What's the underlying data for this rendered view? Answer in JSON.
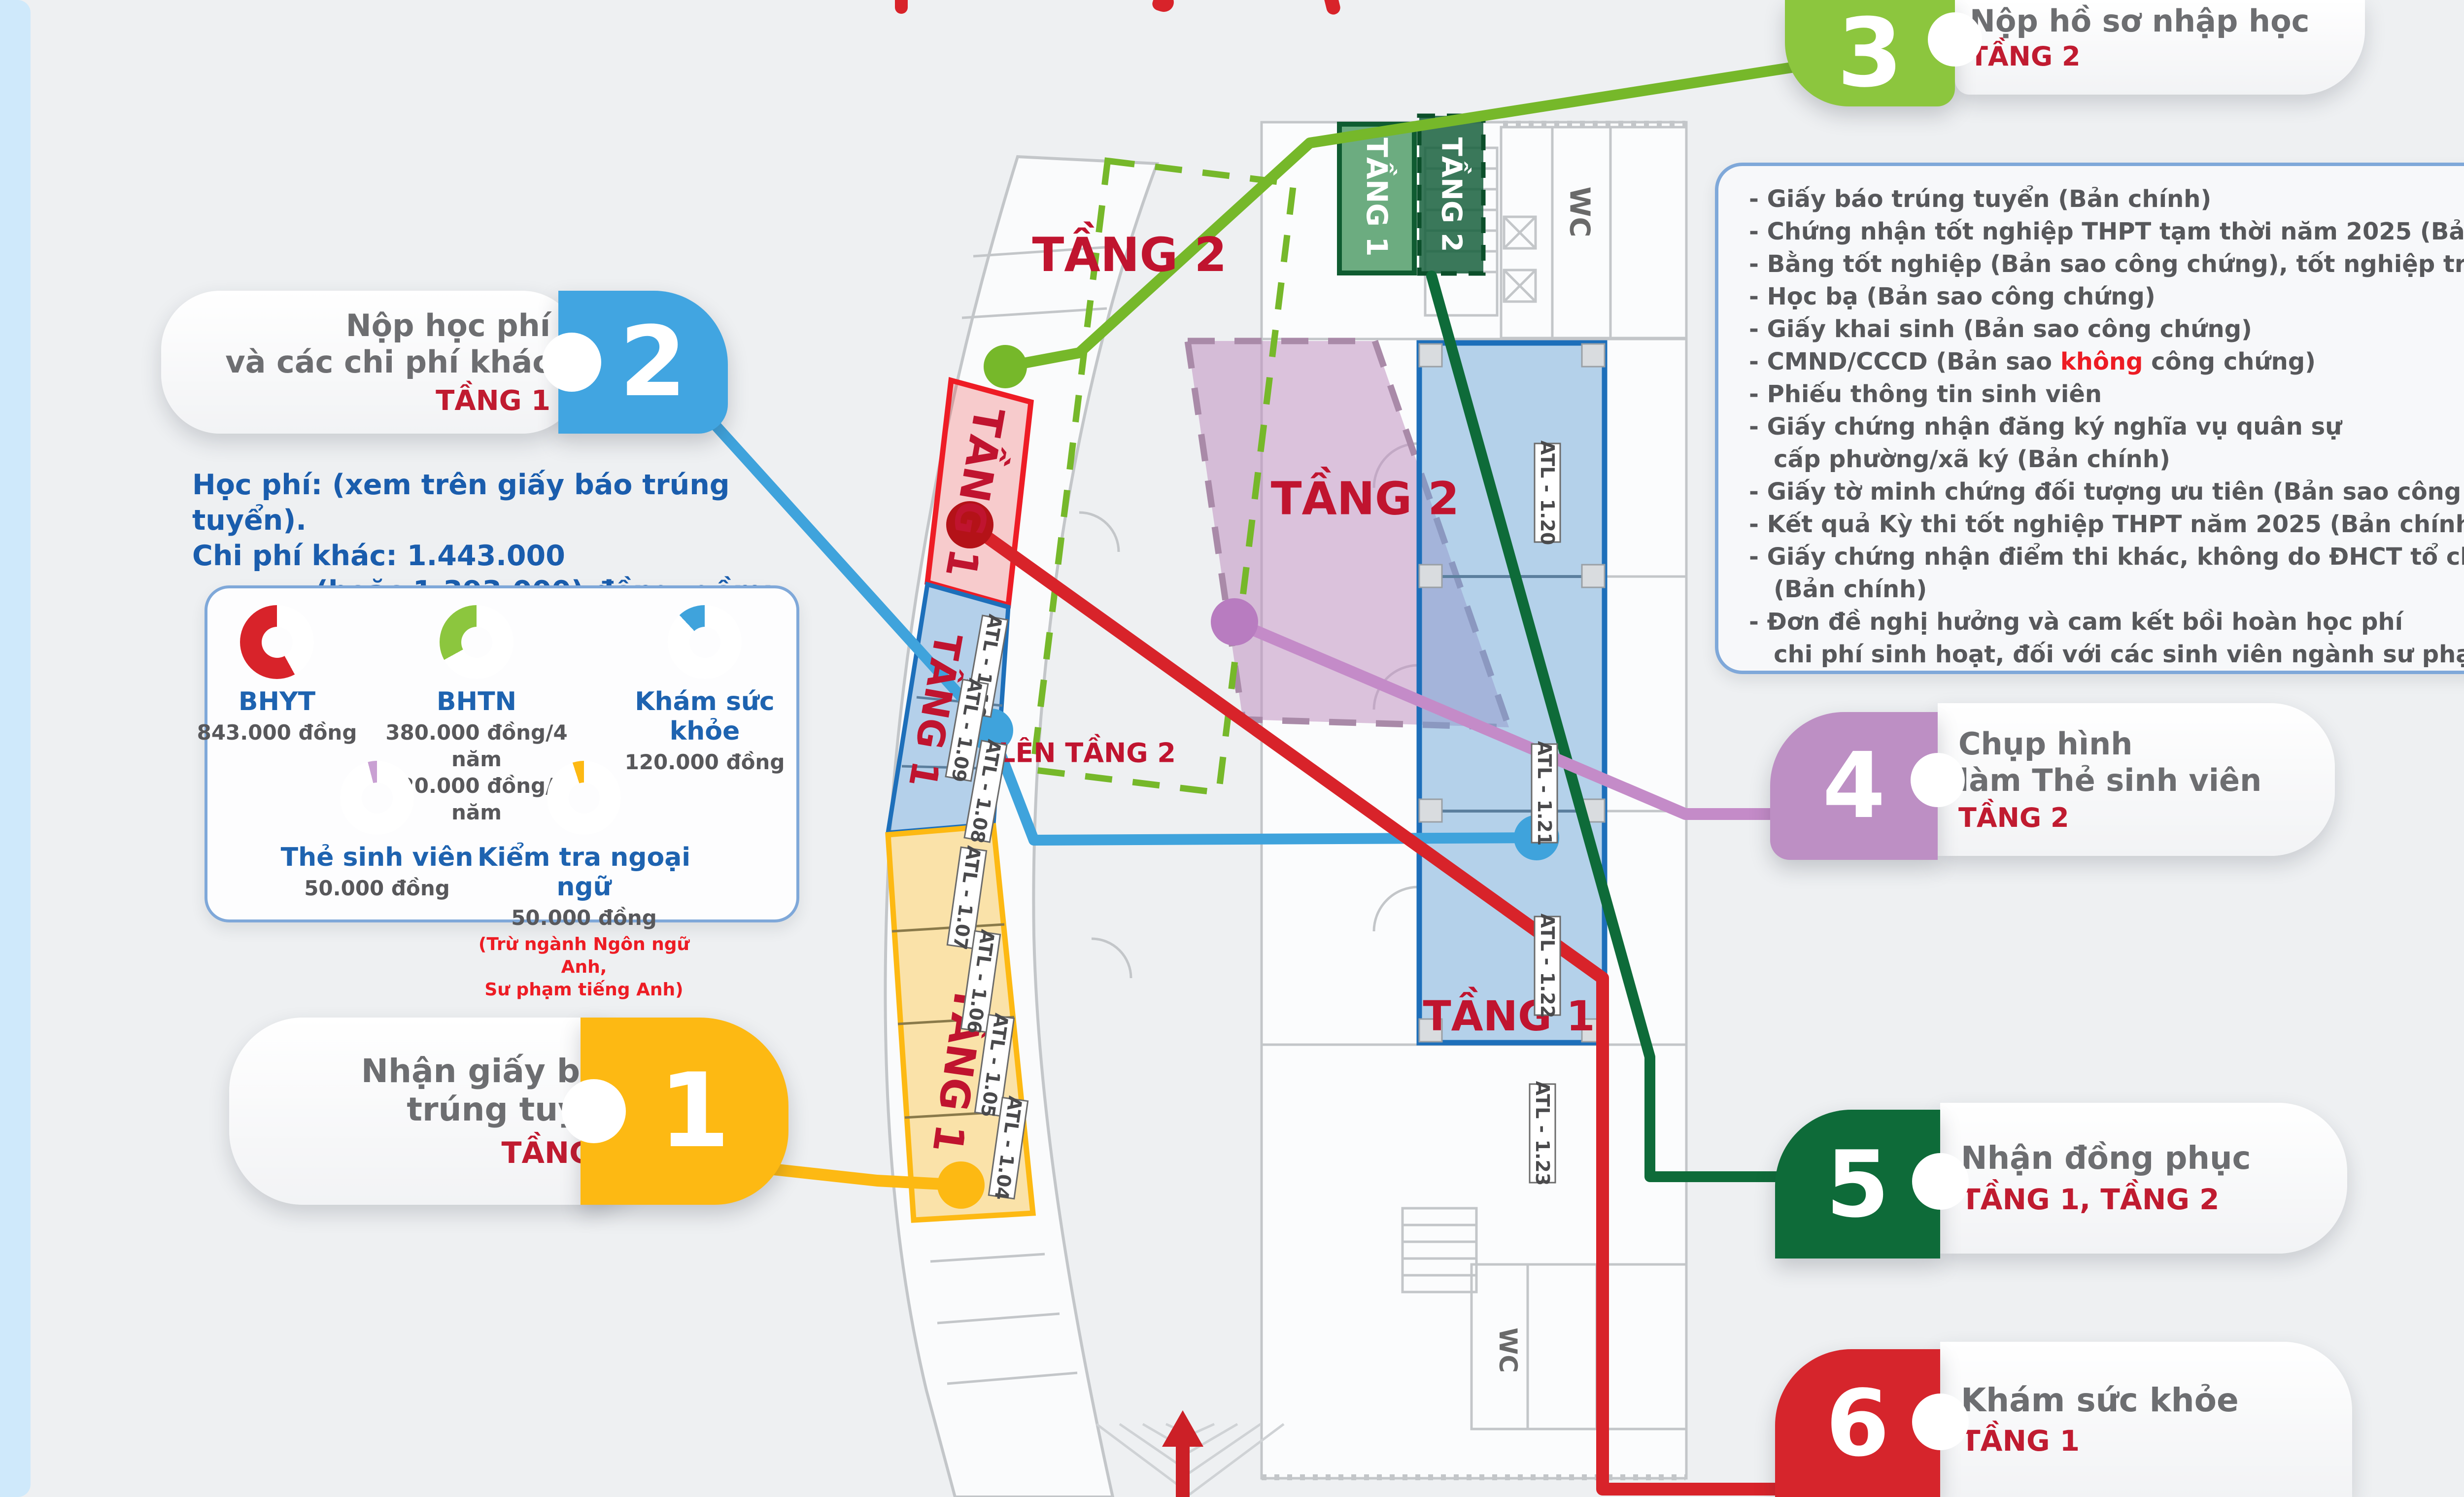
{
  "badges": [
    {
      "num": "1",
      "line1": "Nhận giấy báo",
      "line2": "trúng tuyển",
      "floor": "TẦNG 1",
      "color": "#fdb913"
    },
    {
      "num": "2",
      "line1": "Nộp học phí",
      "line2": "và các chi phí khác",
      "floor": "TẦNG 1",
      "color": "#41a5e1"
    },
    {
      "num": "3",
      "line1": "Nộp hồ sơ nhập học",
      "line2": "",
      "floor": "TẦNG 2",
      "color": "#8cc63e"
    },
    {
      "num": "4",
      "line1": "Chụp hình",
      "line2": "làm Thẻ sinh viên",
      "floor": "TẦNG 2",
      "color": "#bd8fc4"
    },
    {
      "num": "5",
      "line1": "Nhận đồng phục",
      "line2": "",
      "floor": "TẦNG 1, TẦNG 2",
      "color": "#0e6b39"
    },
    {
      "num": "6",
      "line1": "Khám sức khỏe",
      "line2": "",
      "floor": "TẦNG 1",
      "color": "#d6252c"
    }
  ],
  "docs": {
    "lines_before": [
      "- Giấy báo trúng tuyển (Bản chính)",
      "- Chứng nhận tốt nghiệp THPT tạm thời năm 2025 (Bản chính)",
      "- Bằng tốt nghiệp (Bản sao công chứng), tốt nghiệp trước 2025",
      "- Học bạ (Bản sao công chứng)",
      "- Giấy khai sinh (Bản sao công chứng)"
    ],
    "cmnd": {
      "pre": "- CMND/CCCD (Bản sao ",
      "highlight": "không",
      "post": " công chứng)"
    },
    "lines_after": [
      "- Phiếu thông tin sinh viên",
      "- Giấy chứng nhận đăng ký nghĩa vụ quân sự",
      "   cấp phường/xã ký (Bản chính)",
      "- Giấy tờ minh chứng đối tượng ưu tiên (Bản sao công chứng)",
      "- Kết quả Kỳ thi tốt nghiệp THPT năm 2025 (Bản chính)",
      "- Giấy chứng nhận điểm thi khác, không do ĐHCT tổ chức",
      "   (Bản chính)",
      "- Đơn đề nghị hưởng và cam kết bồi hoàn học phí",
      "   chi phí sinh hoạt, đối với các sinh viên ngành sư phạm"
    ]
  },
  "fees": {
    "heading_line1": "Học phí: (xem trên giấy báo trúng tuyển).",
    "heading_line2": "Chi phí khác: 1.443.000",
    "heading_line3": "(hoặc 1.393.000) đồng, gồm:",
    "items": [
      {
        "name": "BHYT",
        "percent": 58,
        "color": "#d8232a",
        "amount1": "843.000 đồng",
        "amount2": ""
      },
      {
        "name": "BHTN",
        "percent": 33,
        "color": "#8cc63e",
        "amount1": "380.000 đồng/4 năm",
        "amount2": "120.000 đồng/1 năm"
      },
      {
        "name": "Khám sức khỏe",
        "percent": 12,
        "color": "#3fa3dc",
        "amount1": "120.000 đồng",
        "amount2": ""
      },
      {
        "name": "Thẻ sinh viên",
        "percent": 4,
        "color": "#c9a0d3",
        "amount1": "50.000 đồng",
        "amount2": ""
      },
      {
        "name": "Kiểm tra ngoại ngữ",
        "percent": 5,
        "color": "#fdb913",
        "amount1": "50.000 đồng",
        "amount2": "",
        "note1": "(Trừ ngành Ngôn ngữ Anh,",
        "note2": "Sư phạm tiếng Anh)"
      }
    ]
  },
  "plan": {
    "regions": {
      "tang2_dashed": "TẦNG 2",
      "tang1_red": "TẦNG 1",
      "tang2_purple": "TẦNG 2",
      "tang1_blue_left": "TẦNG 1",
      "tang1_yellow": "TẦNG 1",
      "tang1_blue_right": "TẦNG 1",
      "tang1_green_box": "TẦNG 1",
      "tang2_green_box": "TẦNG 2",
      "len_tang2": "LÊN TẦNG 2"
    },
    "rooms_left": [
      "ATL - 1.10",
      "ATL - 1.09",
      "ATL - 1.08"
    ],
    "rooms_yellow": [
      "ATL - 1.07",
      "ATL - 1.06",
      "ATL - 1.05",
      "ATL - 1.04"
    ],
    "rooms_right": [
      "ATL - 1.20",
      "ATL - 1.21",
      "ATL - 1.22",
      "ATL - 1.23"
    ],
    "wc_label": "WC"
  },
  "colors": {
    "step1": "#fdb913",
    "step2": "#41a5e1",
    "step3": "#8cc63e",
    "step4": "#bd8fc4",
    "step5": "#0e6b39",
    "step6": "#d6252c",
    "floor_red": "#c01b30",
    "heading_gray": "#6d6e71",
    "doc_text": "#57585b",
    "blue_text": "#1a5dad",
    "edge_blue": "#cfe9fb"
  }
}
